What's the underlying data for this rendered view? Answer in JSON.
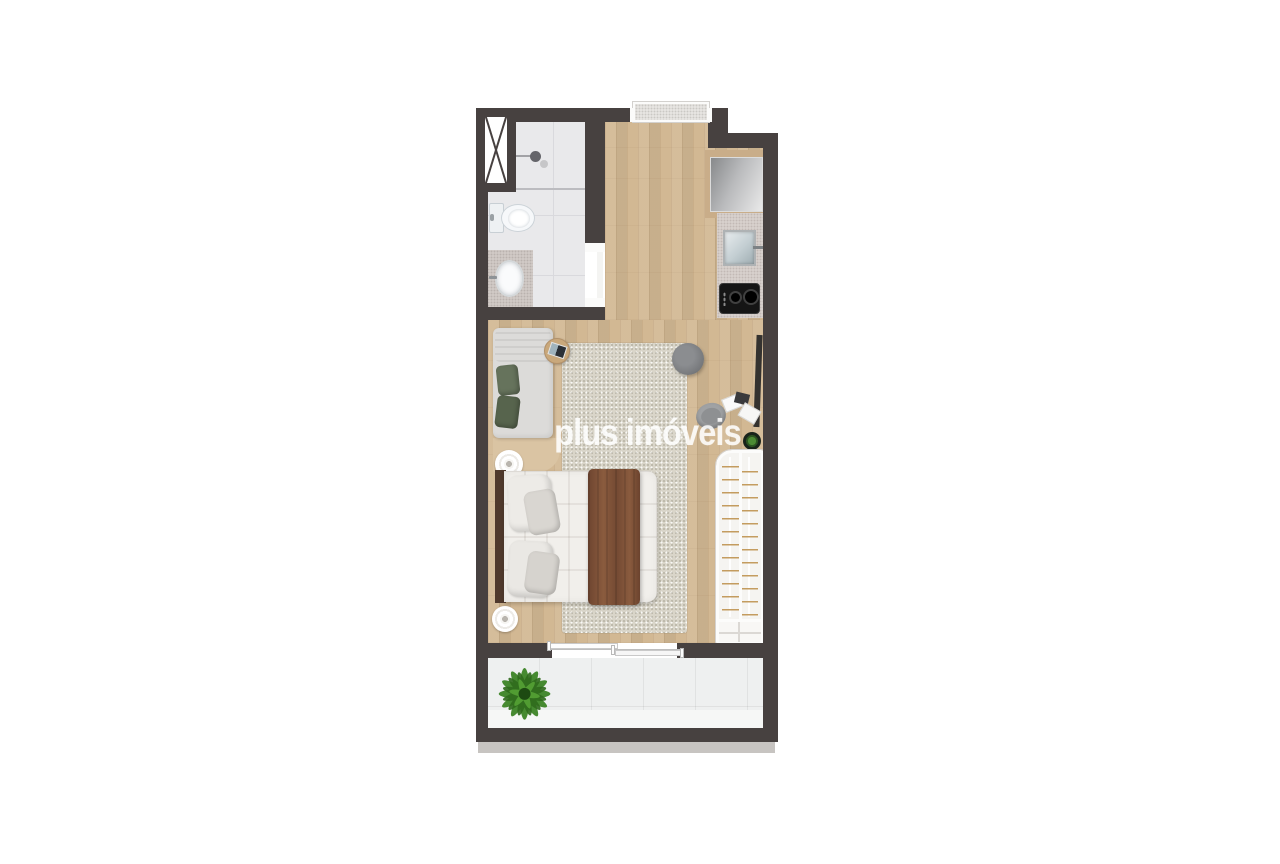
{
  "watermark": {
    "text": "plus imóveis",
    "color": "#ffffff",
    "opacity": 0.82
  },
  "plan": {
    "type": "studio-apartment-floor-plan-top-view",
    "rooms": [
      "bathroom",
      "kitchen",
      "living-sleeping-area",
      "balcony"
    ],
    "furniture_and_fixtures": [
      "ventilation-shaft",
      "shower",
      "toilet",
      "vanity-sink",
      "bathroom-door",
      "entrance-door-threshold",
      "refrigerator",
      "kitchen-counter",
      "kitchen-sink",
      "cooktop-two-burners",
      "sofa-with-green-pillows",
      "round-laptop-side-table",
      "area-rug",
      "round-pouf",
      "wall-mounted-tv",
      "desk-chair",
      "desk-papers-and-tablet",
      "small-potted-plant",
      "double-bed-with-brown-blanket",
      "round-side-table",
      "round-nightstand",
      "wardrobe-with-hangers",
      "sliding-glass-door",
      "balcony-plant"
    ],
    "colors": {
      "wall": "#474140",
      "wood_floor": "#d2b893",
      "bathroom_tile": "#e9e9eb",
      "kitchen_counter": "#d7d0cc",
      "rug": "#d9d5c9",
      "balcony_tile": "#eef0f0",
      "outer_ledge": "#c7c4c1",
      "bed_quilt": "#f1efeb",
      "blanket_brown": "#7a4e35",
      "headboard_wood": "#4f392c",
      "pillow_green": "#66735c",
      "plant_green": "#3e8527",
      "hanger_tan": "#c49c5f",
      "pouf_gray": "#77797c",
      "cooktop_black": "#151515"
    }
  }
}
